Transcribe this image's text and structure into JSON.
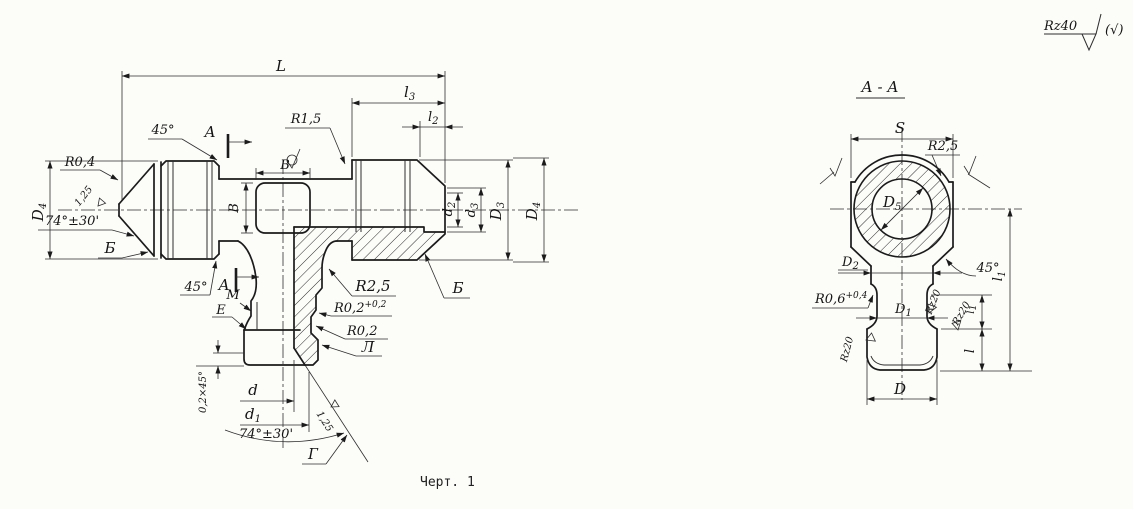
{
  "surface_note": {
    "value": "Rz40",
    "rest": "(√)"
  },
  "caption": "Черт. 1",
  "main_view": {
    "dim_L": "L",
    "dim_l3": {
      "b": "l",
      "s": "3"
    },
    "dim_l2": {
      "b": "l",
      "s": "2"
    },
    "dim_D4_left": {
      "b": "D",
      "s": "4"
    },
    "dim_D4_right": {
      "b": "D",
      "s": "4"
    },
    "dim_D3": {
      "b": "D",
      "s": "3"
    },
    "dim_d3": {
      "b": "d",
      "s": "3"
    },
    "dim_d2": {
      "b": "d",
      "s": "2"
    },
    "dim_d": "d",
    "dim_d1": {
      "b": "d",
      "s": "1"
    },
    "dim_B_width": "В",
    "dim_B_height": "В",
    "chamfer_top": "45°",
    "chamfer_bottom": "45°",
    "chamfer_port": "0,2×45°",
    "cone_angle_left": "74°±30'",
    "cone_angle_bottom": "74°±30'",
    "radius_tip": "R0,4",
    "radius_thread": "R1,5",
    "radius_branch": "R2,5",
    "radius_groove": {
      "b": "R0,2",
      "s": "+0,2"
    },
    "radius_small": "R0,2",
    "rough_left": "1,25",
    "rough_bottom": "1,25",
    "section_mark_top": "А",
    "section_mark_bottom": "А",
    "surf_B_left": "Б",
    "surf_B_right": "Б",
    "surf_M": "М",
    "surf_E": "Е",
    "surf_L": "Л",
    "surf_G": "Г"
  },
  "section_view": {
    "title": "А - А",
    "dim_S": "S",
    "radius_top": "R2,5",
    "dim_D5": {
      "b": "D",
      "s": "5"
    },
    "dim_D2": {
      "b": "D",
      "s": "2"
    },
    "dim_D1": {
      "b": "D",
      "s": "1"
    },
    "dim_D": "D",
    "radius_neck": {
      "b": "R0,6",
      "s": "+0,4"
    },
    "chamfer": "45°",
    "dim_l1_outer": {
      "b": "l",
      "s": "1"
    },
    "dim_l1_inner": {
      "b": "l",
      "s": "1"
    },
    "dim_l": "l",
    "rough_neck_right": "Rz20",
    "rough_thread_right": "Rz20",
    "rough_thread_left": "Rz20"
  }
}
